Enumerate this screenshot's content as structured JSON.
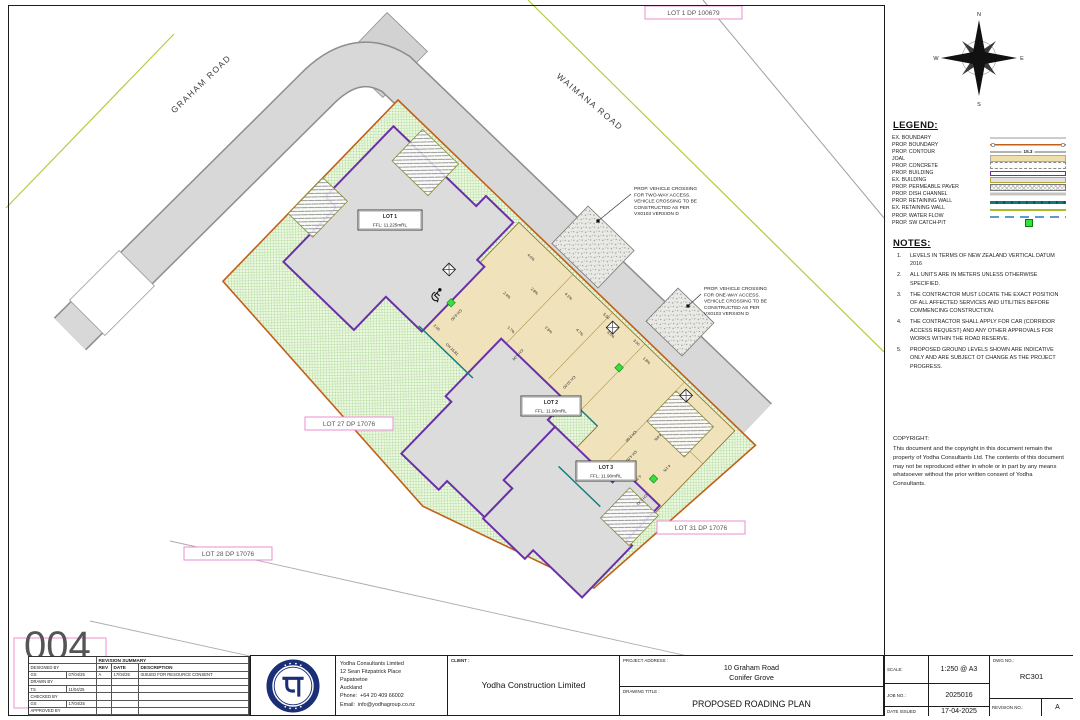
{
  "sheet": {
    "corner_number": "004"
  },
  "compass": {
    "n": "N",
    "e": "E",
    "s": "S",
    "w": "W"
  },
  "icons": {
    "north_arrow": "compass-rose-icon",
    "accessibility": "wheelchair-icon",
    "logo": "yodha-logo-icon"
  },
  "colors": {
    "prop_building": "#7030a0",
    "prop_boundary": "#c25f17",
    "joal": "#f0e2ba",
    "prop_retaining": "#0d7b7b",
    "ex_retaining": "#a6bd28",
    "water_flow": "#5b9bd5",
    "catch_pit": "#35e23c",
    "dp_label_pink": "#ee8ed2"
  },
  "legend": {
    "title": "LEGEND:",
    "items": [
      {
        "label": "EX. BOUNDARY",
        "swatch": "ex-boundary"
      },
      {
        "label": "PROP. BOUNDARY",
        "swatch": "prop-boundary"
      },
      {
        "label": "PROP. CONTOUR",
        "swatch": "prop-contour",
        "value": "15.3"
      },
      {
        "label": "JOAL",
        "swatch": "joal"
      },
      {
        "label": "PROP. CONCRETE",
        "swatch": "prop-concrete"
      },
      {
        "label": "PROP. BUILDING",
        "swatch": "prop-building"
      },
      {
        "label": "EX. BUILDING",
        "swatch": "ex-building"
      },
      {
        "label": "PROP. PERMEABLE PAVER",
        "swatch": "permeable-paver"
      },
      {
        "label": "PROP. DISH CHANNEL",
        "swatch": "dish-channel"
      },
      {
        "label": "PROP. RETAINING WALL",
        "swatch": "prop-retaining"
      },
      {
        "label": "EX. RETAINING WALL",
        "swatch": "ex-retaining"
      },
      {
        "label": "PROP. WATER FLOW",
        "swatch": "water-flow"
      },
      {
        "label": "PROP. SW CATCH-PIT",
        "swatch": "catch-pit"
      }
    ]
  },
  "notes": {
    "title": "NOTES:",
    "items": [
      "LEVELS IN TERMS OF NEW ZEALAND VERTICAL DATUM 2016",
      "ALL UNITS ARE IN METERS UNLESS OTHERWISE SPECIFIED.",
      "THE CONTRACTOR MUST LOCATE THE EXACT POSITION OF ALL AFFECTED SERVICES AND UTILITIES BEFORE COMMENCING CONSTRUCTION.",
      "THE CONTRACTOR SHALL APPLY FOR CAR (CORRIDOR ACCESS REQUEST) AND ANY OTHER APPROVALS FOR WORKS WITHIN THE ROAD RESERVE.",
      "PROPOSED GROUND LEVELS SHOWN ARE INDICATIVE ONLY AND ARE SUBJECT OT CHANGE AS THE PROJECT PROGRESS."
    ]
  },
  "copyright": {
    "title": "COPYRIGHT:",
    "text": "This document and the copyright in this document remain the property of Yodha Consultants Ltd.  The contents of this document may not be reproduced either in whole or in part by any means whatsoever without the prior written consent of Yodha Consultants."
  },
  "titleblock": {
    "scale_label": "SCALE:",
    "scale": "1:250 @ A3",
    "job_label": "JOB NO.:",
    "job": "2025016",
    "date_label": "DATE ISSUED",
    "date": "17-04-2025",
    "dwg_label": "DWG NO.:",
    "dwg": "RC301",
    "rev_label": "REVISION NO.:",
    "rev": "A"
  },
  "revision_summary": {
    "title": "REVISION SUMMARY",
    "columns": [
      "REV",
      "DATE",
      "DESCRIPTION"
    ],
    "entries": [
      {
        "rev": "A",
        "date": "17/04/25",
        "description": "ISSUED FOR RESOURCE CONSENT"
      }
    ],
    "signoff": [
      {
        "role": "DESIGNED BY",
        "initials": "GS",
        "date": "07/04/25"
      },
      {
        "role": "DRAWN BY",
        "initials": "TS",
        "date": "11/04/25"
      },
      {
        "role": "CHECKED BY",
        "initials": "GS",
        "date": "17/04/25"
      },
      {
        "role": "APPROVED BY",
        "initials": "",
        "date": ""
      }
    ]
  },
  "company": {
    "name": "Yodha Consultants Limited",
    "address1": "12 Sean Fitzpatrick Place",
    "address2": "Papatoetoe",
    "address3": "Auckland",
    "phone_label": "Phone:",
    "phone": "+64 20 409 66002",
    "email_label": "Email:",
    "email": "info@yodhagroup.co.nz"
  },
  "client": {
    "label": "CLIENT :",
    "name": "Yodha Construction Limited"
  },
  "project": {
    "label": "PROJECT ADDRESS :",
    "line1": "10 Graham Road",
    "line2": "Conifer Grove",
    "title_label": "DRAWING TITLE :",
    "title": "PROPOSED ROADING PLAN"
  },
  "plan": {
    "road_labels": [
      {
        "text": "GRAHAM ROAD",
        "x": 203,
        "y": 86,
        "rotate": -44
      },
      {
        "text": "WAIMANA ROAD",
        "x": 588,
        "y": 104,
        "rotate": 40
      }
    ],
    "dp_labels": [
      {
        "text": "LOT 1 DP 100679",
        "x": 645,
        "y": 6,
        "w": 97
      },
      {
        "text": "LOT 27 DP 17076",
        "x": 305,
        "y": 417,
        "w": 88
      },
      {
        "text": "LOT 28 DP 17076",
        "x": 184,
        "y": 547,
        "w": 88
      },
      {
        "text": "LOT 31 DP 17076",
        "x": 657,
        "y": 521,
        "w": 88
      }
    ],
    "lot_labels": [
      {
        "name": "LOT 1",
        "ffl": "FFL: 11.225mRL",
        "x": 358,
        "y": 210,
        "w": 64
      },
      {
        "name": "LOT 2",
        "ffl": "FFL: 11.90mRL",
        "x": 521,
        "y": 396,
        "w": 60
      },
      {
        "name": "LOT 3",
        "ffl": "FFL: 11.90mRL",
        "x": 576,
        "y": 461,
        "w": 60
      }
    ],
    "annotations": [
      {
        "lines": [
          "PROP. VEHICLE CROSSING",
          "FOR TWO-WAY ACCESS.",
          "VEHICLE CROSSING TO BE",
          "CONSTRUCTED AS PER",
          "VX0103 VERSION D"
        ],
        "x": 634,
        "y": 190,
        "lx": 598,
        "ly": 221
      },
      {
        "lines": [
          "PROP. VEHICLE CROSSING",
          "FOR ONE-WAY ACCESS.",
          "VEHICLE CROSSING TO BE",
          "CONSTRUCTED AS PER",
          "VX0103 VERSION D"
        ],
        "x": 704,
        "y": 290,
        "lx": 688,
        "ly": 306
      }
    ],
    "dim_labels": [
      {
        "t": "4.0%",
        "x": 205,
        "y": 22,
        "r": 0
      },
      {
        "t": "2.8%",
        "x": 231,
        "y": 44,
        "r": 0
      },
      {
        "t": "4.1%",
        "x": 259,
        "y": 24,
        "r": 0
      },
      {
        "t": "2.4%",
        "x": 214,
        "y": 66,
        "r": 0
      },
      {
        "t": "1.7%",
        "x": 241,
        "y": 88,
        "r": 0
      },
      {
        "t": "2.5%",
        "x": 268,
        "y": 62,
        "r": 0
      },
      {
        "t": "4.7%",
        "x": 292,
        "y": 42,
        "r": 0
      },
      {
        "t": "3.0%",
        "x": 316,
        "y": 22,
        "r": 0
      },
      {
        "t": "1.8%",
        "x": 360,
        "y": 16,
        "r": 0
      },
      {
        "t": "4.6%",
        "x": 420,
        "y": 62,
        "r": 90
      },
      {
        "t": "4.1%",
        "x": 448,
        "y": 78,
        "r": 90
      },
      {
        "t": "4.7%",
        "x": 434,
        "y": 106,
        "r": 90
      },
      {
        "t": "5.50",
        "x": 300,
        "y": 12,
        "r": 0
      },
      {
        "t": "3.00",
        "x": 340,
        "y": 10,
        "r": 0
      },
      {
        "t": "2.00",
        "x": 186,
        "y": 138,
        "r": 0
      },
      {
        "t": "CH 0.00",
        "x": 190,
        "y": 114,
        "r": 90
      },
      {
        "t": "CH 5.00",
        "x": 262,
        "y": 100,
        "r": 90
      },
      {
        "t": "CH 10.00",
        "x": 318,
        "y": 84,
        "r": 90
      },
      {
        "t": "CH 15.81",
        "x": 212,
        "y": 143,
        "r": 0
      },
      {
        "t": "CH 2.00",
        "x": 400,
        "y": 80,
        "r": 90
      },
      {
        "t": "CH 4.00",
        "x": 414,
        "y": 94,
        "r": 90
      },
      {
        "t": "CH 6.42",
        "x": 452,
        "y": 118,
        "r": 90
      }
    ]
  }
}
